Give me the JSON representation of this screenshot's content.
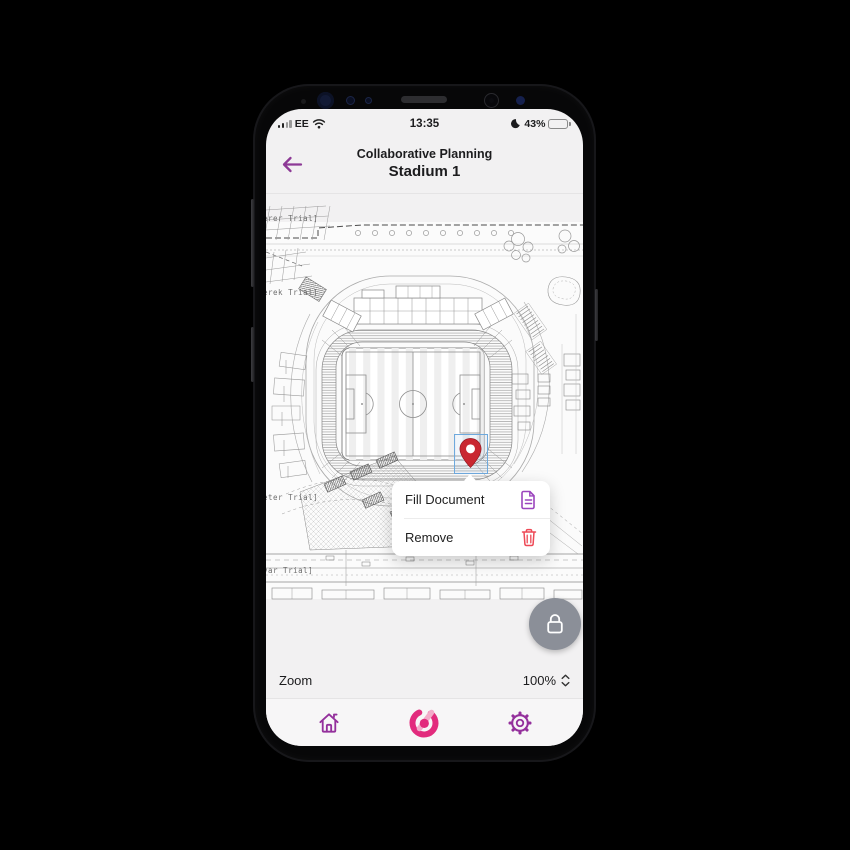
{
  "status_bar": {
    "carrier": "EE",
    "time": "13:35",
    "battery_percent": "43%"
  },
  "header": {
    "title": "Collaborative Planning",
    "subtitle": "Stadium 1"
  },
  "map": {
    "watermarks": [
      "erer Trial]",
      "erek Trial]",
      "eter Trial]",
      "var Trial]"
    ],
    "pin_color": "#c92731",
    "selection_color": "#6ea9dd"
  },
  "context_menu": {
    "items": [
      {
        "label": "Fill Document",
        "icon": "document-icon",
        "icon_color": "#9b45bd"
      },
      {
        "label": "Remove",
        "icon": "trash-icon",
        "icon_color": "#ee4956"
      }
    ]
  },
  "zoom_control": {
    "label": "Zoom",
    "value": "100%"
  },
  "bottom_nav": {
    "items": [
      "home",
      "app-logo",
      "settings"
    ]
  },
  "colors": {
    "accent_purple": "#94309c",
    "brand_pink": "#e22b7d",
    "brand_pink_light": "#f3abc9",
    "pin_red": "#c92731",
    "danger_red": "#ee4956",
    "doc_purple": "#9b45bd",
    "fab_gray": "#8b8f98"
  }
}
